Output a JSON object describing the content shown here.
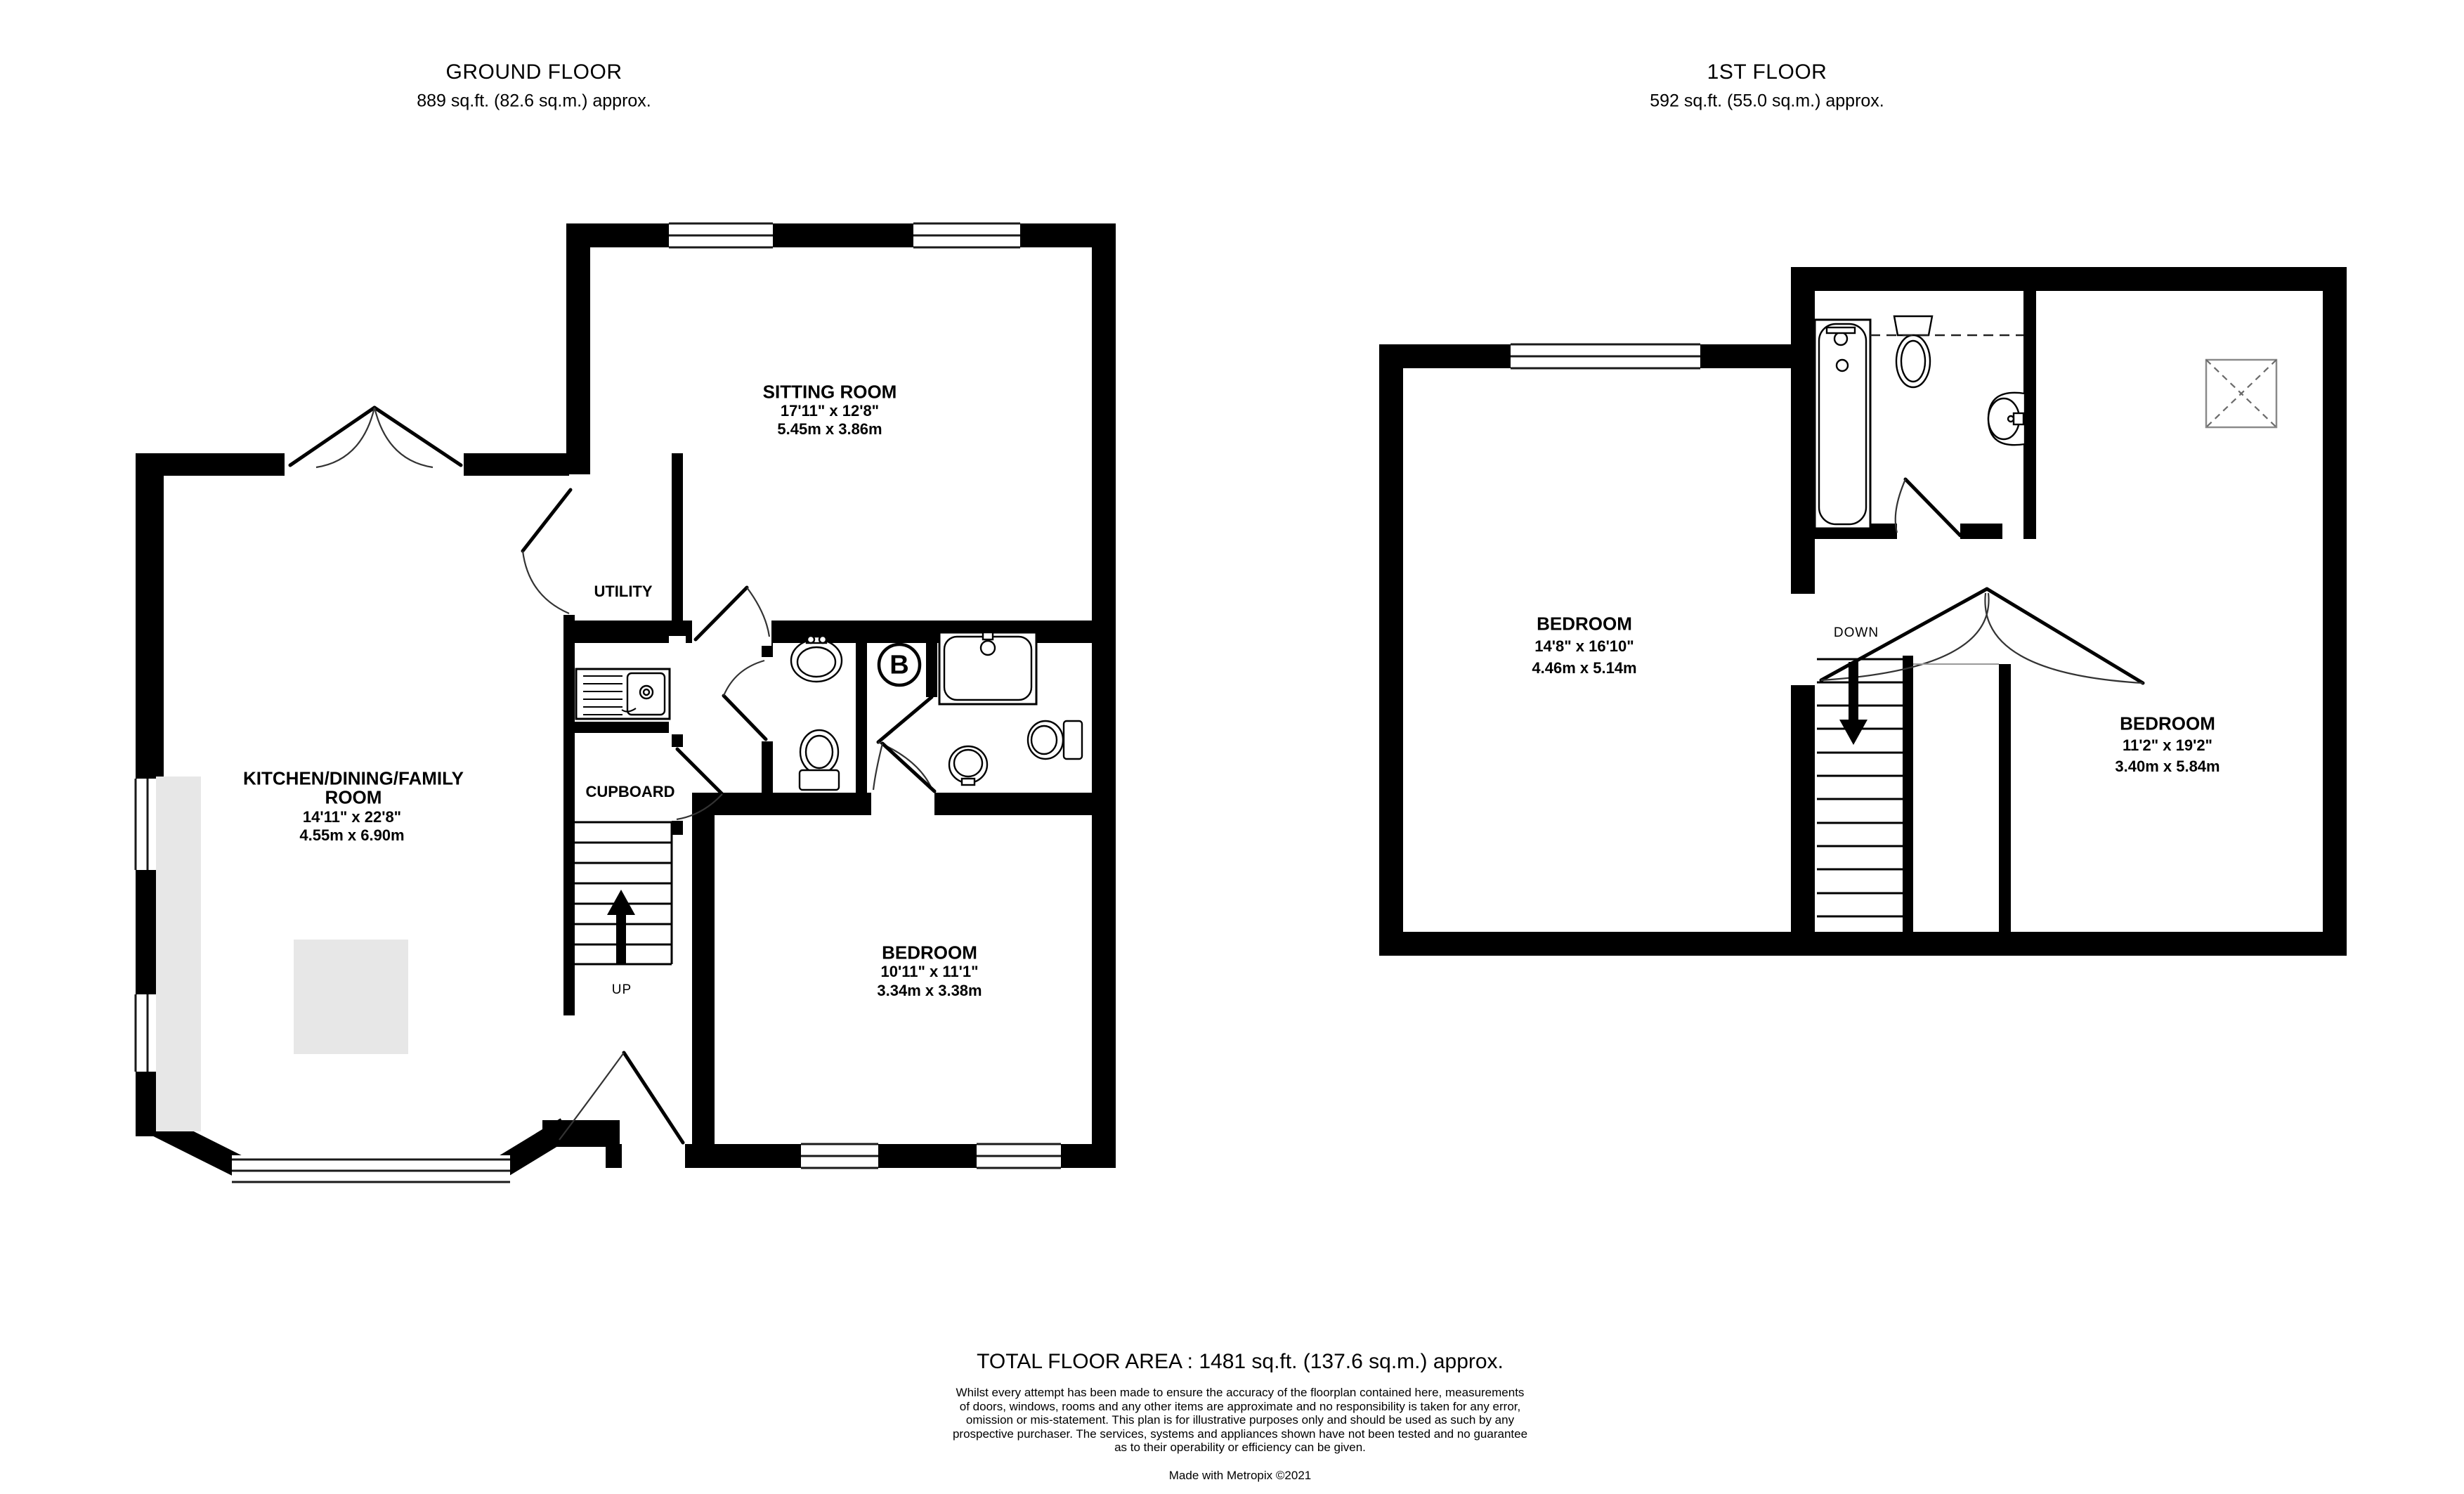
{
  "colors": {
    "wall": "#000000",
    "counter": "#e7e7e7",
    "paper": "#ffffff"
  },
  "ground_floor": {
    "title": "GROUND FLOOR",
    "subtitle": "889 sq.ft. (82.6 sq.m.) approx.",
    "rooms": {
      "sitting": {
        "name": "SITTING ROOM",
        "dims_ft": "17'11\"  x 12'8\"",
        "dims_m": "5.45m  x 3.86m"
      },
      "kitchen": {
        "name_line1": "KITCHEN/DINING/FAMILY",
        "name_line2": "ROOM",
        "dims_ft": "14'11\"  x 22'8\"",
        "dims_m": "4.55m  x 6.90m"
      },
      "bedroom": {
        "name": "BEDROOM",
        "dims_ft": "10'11\"  x 11'1\"",
        "dims_m": "3.34m  x 3.38m"
      },
      "utility": {
        "name": "UTILITY"
      },
      "cupboard": {
        "name": "CUPBOARD"
      }
    },
    "stairs_label": "UP",
    "boiler_label": "B"
  },
  "first_floor": {
    "title": "1ST FLOOR",
    "subtitle": "592 sq.ft. (55.0 sq.m.) approx.",
    "rooms": {
      "bedroom1": {
        "name": "BEDROOM",
        "dims_ft": "14'8\"  x 16'10\"",
        "dims_m": "4.46m  x 5.14m"
      },
      "bedroom2": {
        "name": "BEDROOM",
        "dims_ft": "11'2\"  x 19'2\"",
        "dims_m": "3.40m  x 5.84m"
      }
    },
    "stairs_label": "DOWN"
  },
  "footer": {
    "total": "TOTAL FLOOR AREA : 1481 sq.ft. (137.6 sq.m.) approx.",
    "disclaimer": "Whilst every attempt has been made to ensure the accuracy of the floorplan contained here, measurements\nof doors, windows, rooms and any other items are approximate and no responsibility is taken for any error,\nomission or mis-statement. This plan is for illustrative purposes only and should be used as such by any\nprospective purchaser. The services, systems and appliances shown have not been tested and no guarantee\nas to their operability or efficiency can be given.",
    "credit": "Made with Metropix ©2021"
  }
}
